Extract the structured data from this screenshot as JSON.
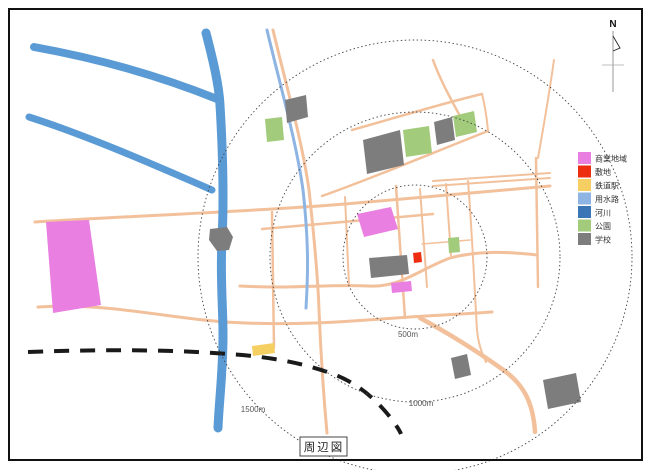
{
  "title": "周辺図",
  "north_label": "N",
  "legend": {
    "items": [
      {
        "label": "商業地域",
        "color": "#e97fe0"
      },
      {
        "label": "敷地",
        "color": "#ee2e10"
      },
      {
        "label": "鉄道駅",
        "color": "#f6cf63"
      },
      {
        "label": "用水路",
        "color": "#8db4e2"
      },
      {
        "label": "河川",
        "color": "#3a76b6"
      },
      {
        "label": "公園",
        "color": "#a2cb7c"
      },
      {
        "label": "学校",
        "color": "#7d7d7d"
      }
    ]
  },
  "rings": [
    {
      "label": "500m"
    },
    {
      "label": "1000m"
    },
    {
      "label": "1500m"
    }
  ],
  "palette": {
    "commercial": "#e97fe0",
    "site": "#ee2e10",
    "station": "#f6cf63",
    "canal": "#8db4e2",
    "river": "#5b9bd5",
    "park": "#a2cb7c",
    "school": "#7d7d7d",
    "road": "#f2c19c",
    "railway": "#1a1a1a",
    "ring": "#444444",
    "frame": "#111111"
  }
}
